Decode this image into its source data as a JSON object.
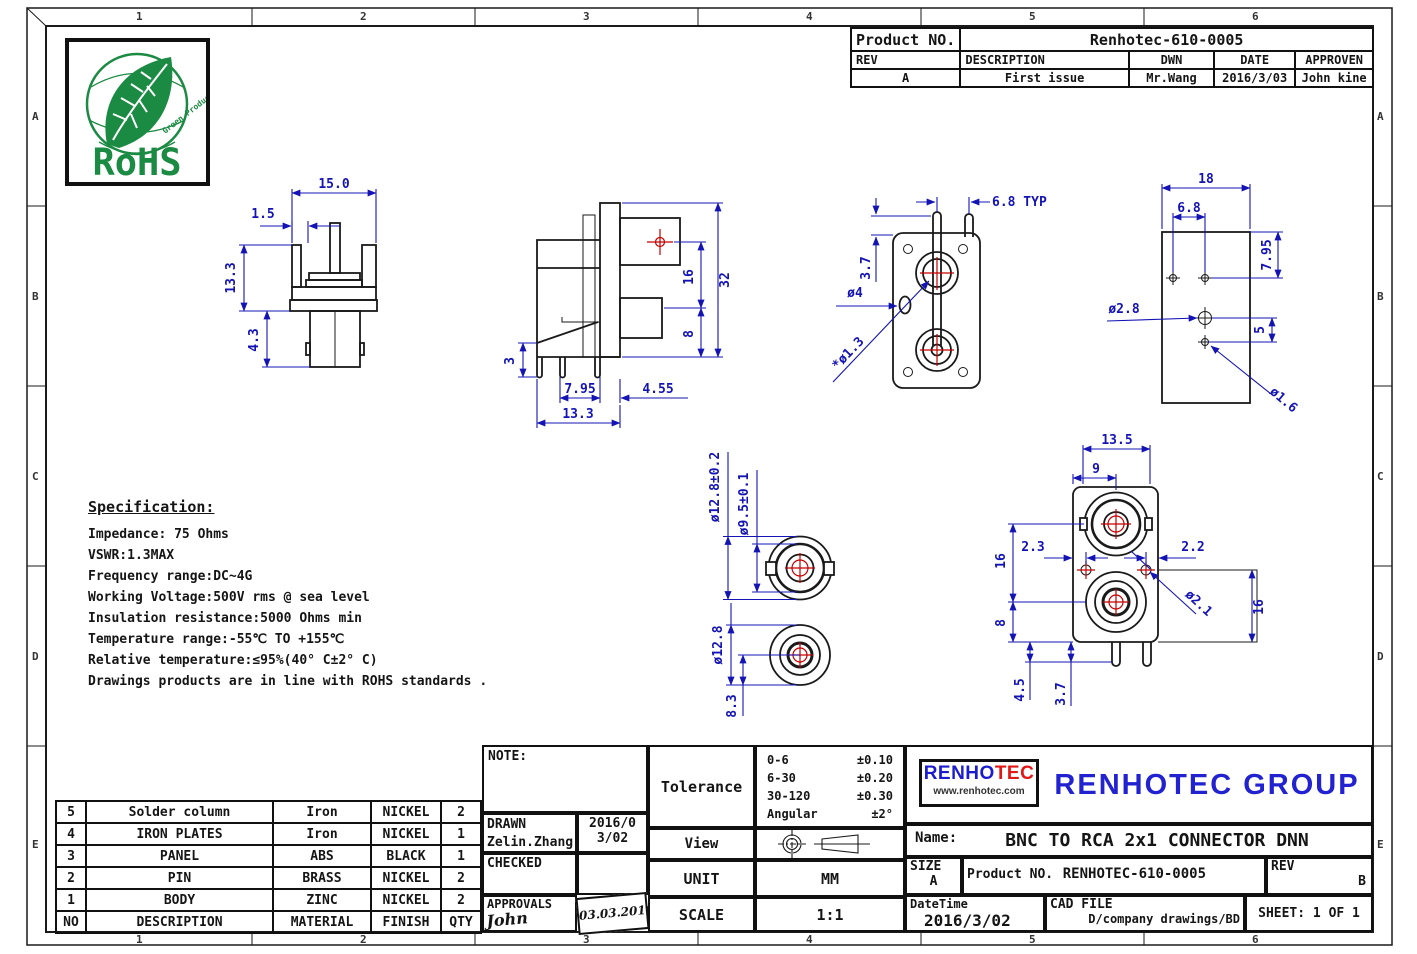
{
  "frame": {
    "columns": [
      "1",
      "2",
      "3",
      "4",
      "5",
      "6"
    ],
    "rows": [
      "A",
      "B",
      "C",
      "D",
      "E"
    ]
  },
  "rohs": {
    "title": "RoHS",
    "subtitle": "Green Product"
  },
  "rev_table": {
    "product_no_label": "Product NO.",
    "product_no_value": "Renhotec-610-0005",
    "headers": [
      "REV",
      "DESCRIPTION",
      "DWN",
      "DATE",
      "APPROVEN"
    ],
    "row": [
      "A",
      "First issue",
      "Mr.Wang",
      "2016/3/03",
      "John kine"
    ]
  },
  "specification": {
    "title": "Specification:",
    "lines": [
      "Impedance: 75 Ohms",
      "VSWR:1.3MAX",
      "Frequency range:DC~4G",
      "Working Voltage:500V rms @ sea level",
      "Insulation resistance:5000 Ohms min",
      "Temperature range:-55℃ TO +155℃",
      "Relative temperature:≤95%(40° C±2° C)",
      "Drawings products are in line with ROHS standards ."
    ]
  },
  "bom": {
    "headers": [
      "NO",
      "DESCRIPTION",
      "MATERIAL",
      "FINISH",
      "QTY"
    ],
    "rows": [
      [
        "5",
        "Solder column",
        "Iron",
        "NICKEL",
        "2"
      ],
      [
        "4",
        "IRON PLATES",
        "Iron",
        "NICKEL",
        "1"
      ],
      [
        "3",
        "PANEL",
        "ABS",
        "BLACK",
        "1"
      ],
      [
        "2",
        "PIN",
        "BRASS",
        "NICKEL",
        "2"
      ],
      [
        "1",
        "BODY",
        "ZINC",
        "NICKEL",
        "2"
      ]
    ]
  },
  "title_block": {
    "note_label": "NOTE:",
    "drawn_label": "DRAWN",
    "drawn_name": "Zelin.Zhang",
    "drawn_date": "2016/03/02",
    "checked_label": "CHECKED",
    "approvals_label": "APPROVALS",
    "approvals_signature": "John Kine",
    "approvals_date": "03.03.2016",
    "tolerance_label": "Tolerance",
    "tolerance_rows": [
      [
        "0-6",
        "±0.10"
      ],
      [
        "6-30",
        "±0.20"
      ],
      [
        "30-120",
        "±0.30"
      ],
      [
        "Angular",
        "±2°"
      ]
    ],
    "view_label": "View",
    "unit_label": "UNIT",
    "unit_value": "MM",
    "scale_label": "SCALE",
    "scale_value": "1:1"
  },
  "company": {
    "logo_blue": "RENHO",
    "logo_red": "TEC",
    "logo_url": "www.renhotec.com",
    "group_name": "RENHOTEC GROUP",
    "name_label": "Name:",
    "name_value": "BNC TO RCA 2x1 CONNECTOR DNN",
    "size_label": "SIZE",
    "size_value": "A",
    "product_no_label": "Product NO.",
    "product_no_value": "RENHOTEC-610-0005",
    "rev_label": "REV",
    "rev_value": "B",
    "datetime_label": "DateTime",
    "datetime_value": "2016/3/02",
    "cad_file_label": "CAD FILE",
    "cad_file_value": "D/company drawings/BD",
    "sheet_value": "SHEET: 1 OF 1"
  },
  "dims": {
    "side_view": {
      "width": "15.0",
      "tab": "1.5",
      "height": "13.3",
      "plug": "4.3"
    },
    "profile_view": {
      "total": "32",
      "upper": "16",
      "lower": "8",
      "pin": "3",
      "pitch": "7.95",
      "offset": "4.55",
      "depth": "13.3"
    },
    "back_view": {
      "pitch": "6.8 TYP",
      "top": "3.7",
      "slot": "ø4",
      "pin": "*ø1.3"
    },
    "footprint_view": {
      "width": "18",
      "pitch": "6.8",
      "row1": "7.95",
      "row2": "5",
      "hole1": "ø2.8",
      "hole2": "ø1.6"
    },
    "bnc_face": {
      "outer": "ø12.8±0.2",
      "inner": "ø9.5±0.1"
    },
    "rca_face": {
      "outer": "ø12.8",
      "offset": "8.3"
    },
    "front_view": {
      "width": "13.5",
      "center_x": "9",
      "left": "2.3",
      "right": "2.2",
      "pitch": "16",
      "lower": "8",
      "side": "16",
      "leg1": "4.5",
      "leg2": "3.7",
      "hole": "ø2.1"
    }
  },
  "colors": {
    "dimension": "#1414b4",
    "outline": "#1a1a1a",
    "center_mark": "#c40000",
    "logo_blue": "#1c1ccf",
    "logo_red": "#e01818",
    "group_blue": "#2222d0",
    "rohs_green": "#1b8a42"
  }
}
